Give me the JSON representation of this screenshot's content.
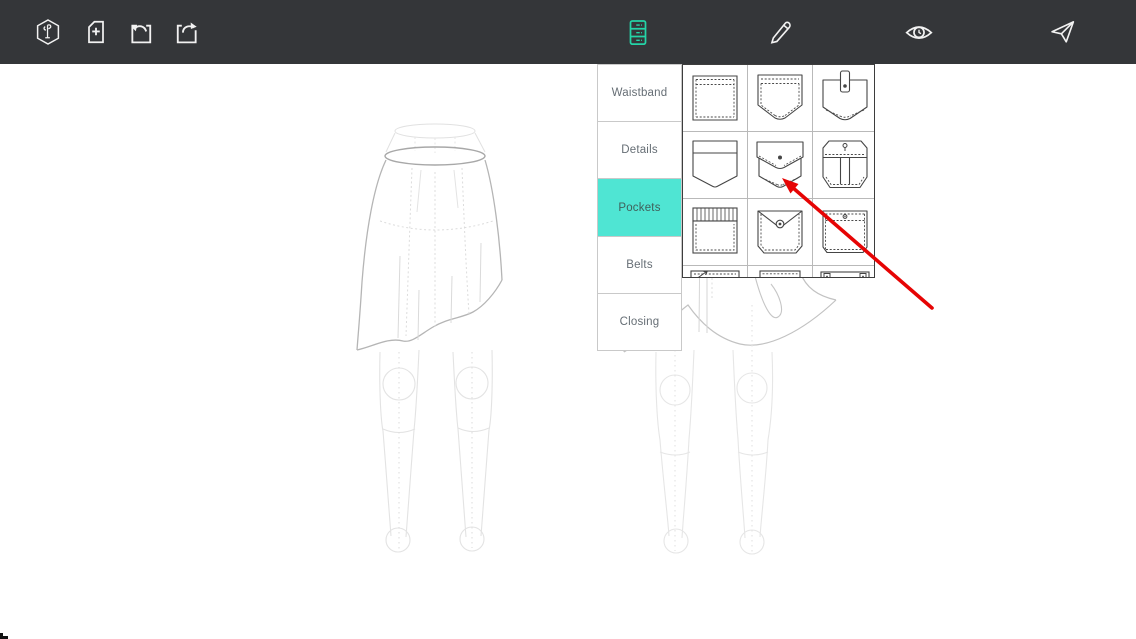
{
  "toolbar": {
    "left_icons": [
      {
        "name": "logo-hexagon-icon"
      },
      {
        "name": "new-document-icon"
      },
      {
        "name": "undo-icon"
      },
      {
        "name": "export-icon"
      }
    ],
    "right_icons": [
      {
        "name": "components-drawer-icon",
        "active": true
      },
      {
        "name": "edit-pencil-icon",
        "active": false
      },
      {
        "name": "preview-eye-icon",
        "active": false
      },
      {
        "name": "send-icon",
        "active": false
      }
    ]
  },
  "panel": {
    "menu_items": [
      {
        "label": "Waistband",
        "selected": false
      },
      {
        "label": "Details",
        "selected": false
      },
      {
        "label": "Pockets",
        "selected": true
      },
      {
        "label": "Belts",
        "selected": false
      },
      {
        "label": "Closing",
        "selected": false
      }
    ],
    "pocket_grid": {
      "rows": 4,
      "cols": 3,
      "cells": [
        {
          "name": "pocket-square-stitched-icon"
        },
        {
          "name": "pocket-curved-bottom-icon"
        },
        {
          "name": "pocket-tab-button-icon"
        },
        {
          "name": "pocket-flat-band-icon"
        },
        {
          "name": "pocket-flap-button-icon"
        },
        {
          "name": "pocket-cargo-two-compartment-icon"
        },
        {
          "name": "pocket-pleated-top-icon"
        },
        {
          "name": "pocket-vflap-ring-snap-icon"
        },
        {
          "name": "pocket-buttoned-top-icon"
        },
        {
          "name": "pocket-welt-zip-icon"
        },
        {
          "name": "pocket-welt-plain-icon"
        },
        {
          "name": "pocket-welt-tabs-icon"
        }
      ]
    }
  },
  "canvas": {
    "figures": [
      {
        "name": "skirt-front-view-sketch"
      },
      {
        "name": "skirt-back-view-sketch"
      }
    ]
  },
  "annotation": {
    "type": "pointer-arrow",
    "points_to": "pocket-flap-button-icon",
    "color": "#e60404"
  },
  "colors": {
    "toolbar_bg": "#343639",
    "accent_teal": "#24d4a7",
    "highlight_turquoise": "#4fe5d3",
    "annotation_red": "#e60404"
  }
}
